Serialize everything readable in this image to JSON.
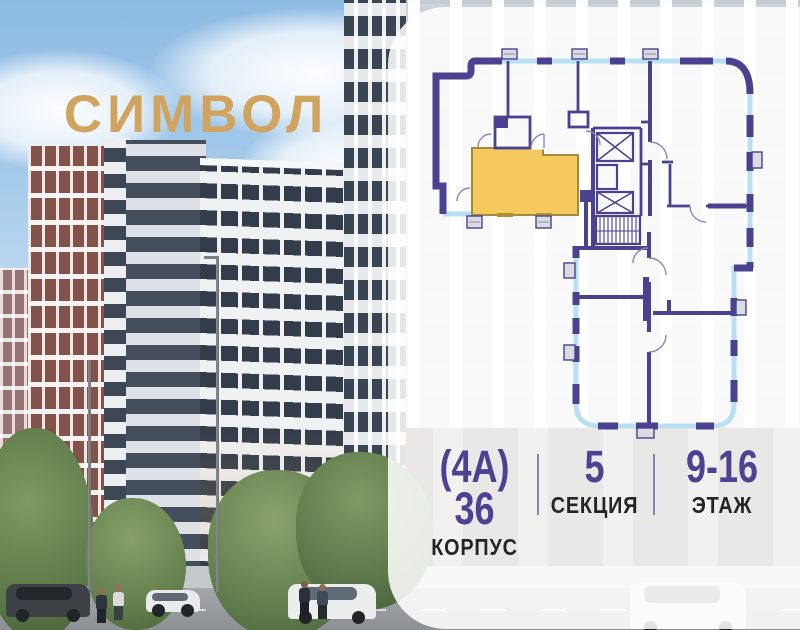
{
  "logo": {
    "text": "СИМВОЛ"
  },
  "apartment_info": {
    "building": {
      "value": "(4А) 36",
      "label": "КОРПУС"
    },
    "section": {
      "value": "5",
      "label": "СЕКЦИЯ"
    },
    "floors": {
      "value": "9-16",
      "label": "ЭТАЖ"
    }
  },
  "colors": {
    "logo_gold": "#d0a45f",
    "plan_wall": "#4a4190",
    "plan_window": "#b7e1f3",
    "plan_highlight": "#f6c95e",
    "plan_highlight_accent": "#b08f35",
    "info_number": "#4b4291",
    "info_label": "#242424",
    "divider": "#8781b5"
  }
}
